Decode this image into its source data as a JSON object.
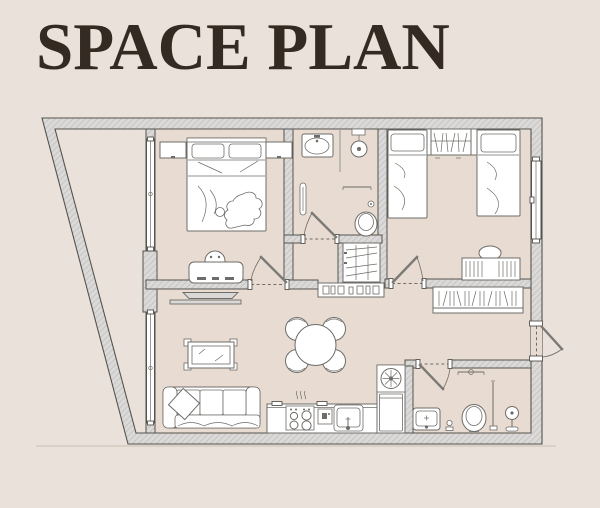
{
  "title": "SPACE PLAN",
  "colors": {
    "background": "#EAE2DA",
    "floor": "#E8DCD2",
    "wall_fill": "#DBDAD8",
    "wall_hatch": "#C7C6C4",
    "wall_line": "#55534F",
    "furniture_fill": "#FFFFFF",
    "furniture_line": "#6E6C68",
    "accent_dark": "#342A22",
    "ground_line": "#D3C9BF"
  },
  "icons": [
    "double-bed-icon",
    "pillow-icon",
    "nightstand-icon",
    "dressing-table-icon",
    "stool-icon",
    "tv-console-icon",
    "sofa-icon",
    "throw-pillow-icon",
    "coffee-table-icon",
    "dining-table-icon",
    "dining-chair-icon",
    "kitchen-counter-icon",
    "hob-icon",
    "steam-icon",
    "coffee-machine-icon",
    "kitchen-sink-icon",
    "extractor-fan-icon",
    "fridge-icon",
    "bathroom-sink-icon",
    "rain-shower-icon",
    "shower-column-icon",
    "toilet-icon",
    "towel-rail-icon",
    "towel-radiator-icon",
    "toilet-brush-icon",
    "single-bed-icon",
    "wardrobe-hangers-icon",
    "desk-icon",
    "desk-chair-icon",
    "bookshelf-icon",
    "console-shelf-icon",
    "window-icon",
    "door-swing-icon",
    "entrance-door-icon"
  ]
}
